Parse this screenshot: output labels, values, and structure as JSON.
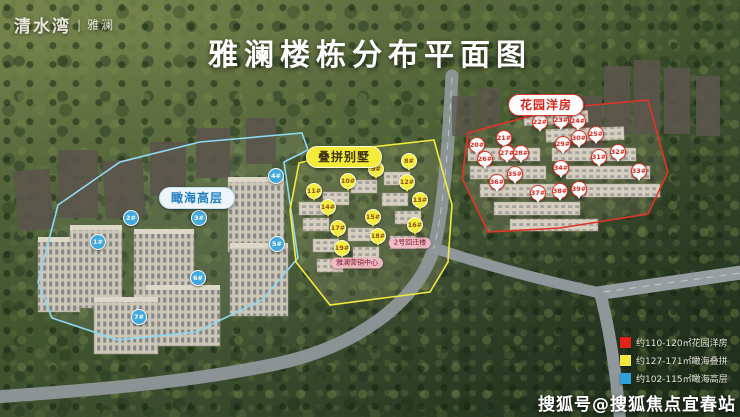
{
  "logo": {
    "brand": "清水湾",
    "divider": "|",
    "product": "雅澜"
  },
  "title": "雅澜楼栋分布平面图",
  "map": {
    "zones": [
      {
        "id": "highrise",
        "label": "瞰海高层",
        "accent": "#42a9de",
        "marker_style": "blue-circle",
        "markers": [
          {
            "no": "1#",
            "x": 97,
            "y": 241
          },
          {
            "no": "2#",
            "x": 130,
            "y": 217
          },
          {
            "no": "3#",
            "x": 198,
            "y": 217
          },
          {
            "no": "4#",
            "x": 275,
            "y": 175
          },
          {
            "no": "5#",
            "x": 276,
            "y": 243
          },
          {
            "no": "6#",
            "x": 197,
            "y": 277
          },
          {
            "no": "7#",
            "x": 138,
            "y": 316
          }
        ]
      },
      {
        "id": "villa",
        "label": "叠拼别墅",
        "accent": "#f2e93c",
        "marker_style": "yellow-pin",
        "markers": [
          {
            "no": "8#",
            "x": 408,
            "y": 160
          },
          {
            "no": "9#",
            "x": 375,
            "y": 168
          },
          {
            "no": "10#",
            "x": 347,
            "y": 180
          },
          {
            "no": "11#",
            "x": 313,
            "y": 190
          },
          {
            "no": "12#",
            "x": 406,
            "y": 181
          },
          {
            "no": "13#",
            "x": 419,
            "y": 199
          },
          {
            "no": "14#",
            "x": 327,
            "y": 206
          },
          {
            "no": "15#",
            "x": 372,
            "y": 216
          },
          {
            "no": "16#",
            "x": 414,
            "y": 224
          },
          {
            "no": "17#",
            "x": 337,
            "y": 227
          },
          {
            "no": "18#",
            "x": 377,
            "y": 235
          },
          {
            "no": "19#",
            "x": 341,
            "y": 247
          }
        ]
      },
      {
        "id": "garden",
        "label": "花园洋房",
        "accent": "#dd2a1e",
        "marker_style": "red-pin",
        "markers": [
          {
            "no": "20#",
            "x": 476,
            "y": 144
          },
          {
            "no": "21#",
            "x": 503,
            "y": 137
          },
          {
            "no": "22#",
            "x": 539,
            "y": 121
          },
          {
            "no": "23#",
            "x": 560,
            "y": 119
          },
          {
            "no": "24#",
            "x": 577,
            "y": 120
          },
          {
            "no": "25#",
            "x": 595,
            "y": 133
          },
          {
            "no": "26#",
            "x": 484,
            "y": 158
          },
          {
            "no": "27#",
            "x": 506,
            "y": 152
          },
          {
            "no": "28#",
            "x": 520,
            "y": 152
          },
          {
            "no": "29#",
            "x": 562,
            "y": 143
          },
          {
            "no": "30#",
            "x": 578,
            "y": 137
          },
          {
            "no": "31#",
            "x": 598,
            "y": 156
          },
          {
            "no": "32#",
            "x": 617,
            "y": 151
          },
          {
            "no": "33#",
            "x": 638,
            "y": 170
          },
          {
            "no": "34#",
            "x": 560,
            "y": 167
          },
          {
            "no": "35#",
            "x": 514,
            "y": 173
          },
          {
            "no": "36#",
            "x": 496,
            "y": 181
          },
          {
            "no": "37#",
            "x": 537,
            "y": 192
          },
          {
            "no": "38#",
            "x": 559,
            "y": 190
          },
          {
            "no": "39#",
            "x": 578,
            "y": 188
          }
        ]
      }
    ],
    "poi_labels": [
      {
        "text": "雅澜营销中心",
        "x": 357,
        "y": 263
      },
      {
        "text": "2号回迁楼",
        "x": 410,
        "y": 243
      }
    ]
  },
  "legend": {
    "items": [
      {
        "color": "#e02318",
        "text": "约110-120㎡花园洋房"
      },
      {
        "color": "#f2e93c",
        "text": "约127-171㎡瞰海叠拼"
      },
      {
        "color": "#2e9fd8",
        "text": "约102-115㎡瞰海高层"
      }
    ]
  },
  "watermark": "搜狐号@搜狐焦点宜春站"
}
